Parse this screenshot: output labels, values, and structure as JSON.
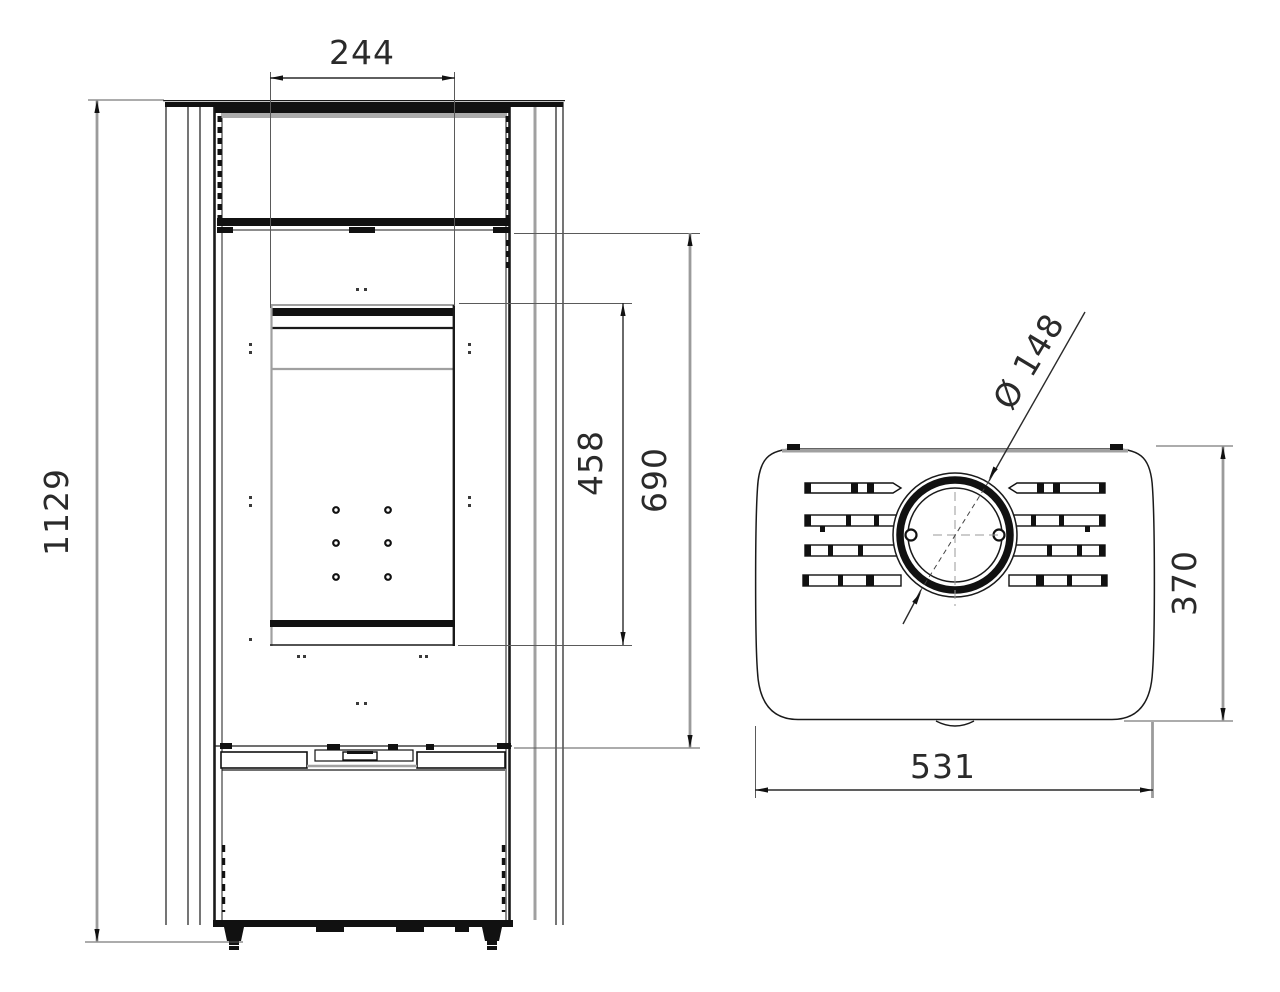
{
  "drawing": {
    "type": "technical-dimension-drawing",
    "views": {
      "front": {
        "label_width_top": "244",
        "label_total_height": "1129",
        "label_door_height": "458",
        "label_body_height": "690"
      },
      "top": {
        "label_flue_diameter": "Ø 148",
        "label_depth": "370",
        "label_width": "531"
      }
    },
    "colors": {
      "object_line": "#1a1a1a",
      "dimension_line": "#9b9b9b",
      "background": "#ffffff"
    }
  }
}
